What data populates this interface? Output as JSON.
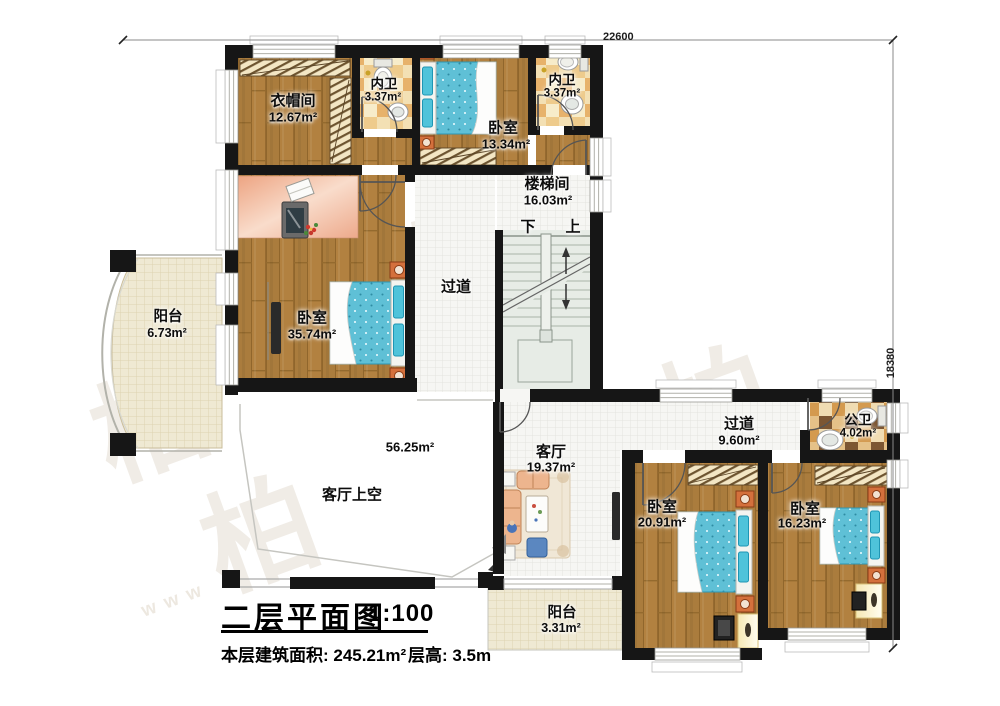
{
  "drawing": {
    "dimensions": {
      "width_mm": "22600",
      "height_mm": "18380"
    },
    "stair_labels": {
      "down": "下",
      "up": "上"
    },
    "rooms": {
      "cloakroom": {
        "name": "衣帽间",
        "area": "12.67m²"
      },
      "ensuite_bath_1": {
        "name": "内卫",
        "area": "3.37m²"
      },
      "bedroom_north": {
        "name": "卧室",
        "area": "13.34m²"
      },
      "ensuite_bath_2": {
        "name": "内卫",
        "area": "3.37m²"
      },
      "stairwell": {
        "name": "楼梯间",
        "area": "16.03m²"
      },
      "corridor_west": {
        "name": "过道"
      },
      "bedroom_master": {
        "name": "卧室",
        "area": "35.74m²"
      },
      "balcony_west": {
        "name": "阳台",
        "area": "6.73m²"
      },
      "living_void": {
        "name": "客厅上空",
        "area": "56.25m²"
      },
      "living_room": {
        "name": "客厅",
        "area": "19.37m²"
      },
      "corridor_east": {
        "name": "过道",
        "area": "9.60m²"
      },
      "public_bath": {
        "name": "公卫",
        "area": "4.02m²"
      },
      "bedroom_southwest": {
        "name": "卧室",
        "area": "20.91m²"
      },
      "bedroom_southeast": {
        "name": "卧室",
        "area": "16.23m²"
      },
      "balcony_south": {
        "name": "阳台",
        "area": "3.31m²"
      }
    },
    "title": {
      "main": "二层平面图",
      "scale": "1:100",
      "floor_area": "本层建筑面积: 245.21m²",
      "floor_height": "层高: 3.5m"
    },
    "watermark": {
      "char": "柏",
      "web": "www"
    }
  },
  "colors": {
    "wall": "#161616",
    "wood_floor": "#aa7c3d",
    "bed_blue": "#5fc0d6",
    "nightstand_orange": "#d4703c",
    "tile_checker_tan": "#e2ba7d",
    "balcony_beige": "#efe9d3"
  }
}
